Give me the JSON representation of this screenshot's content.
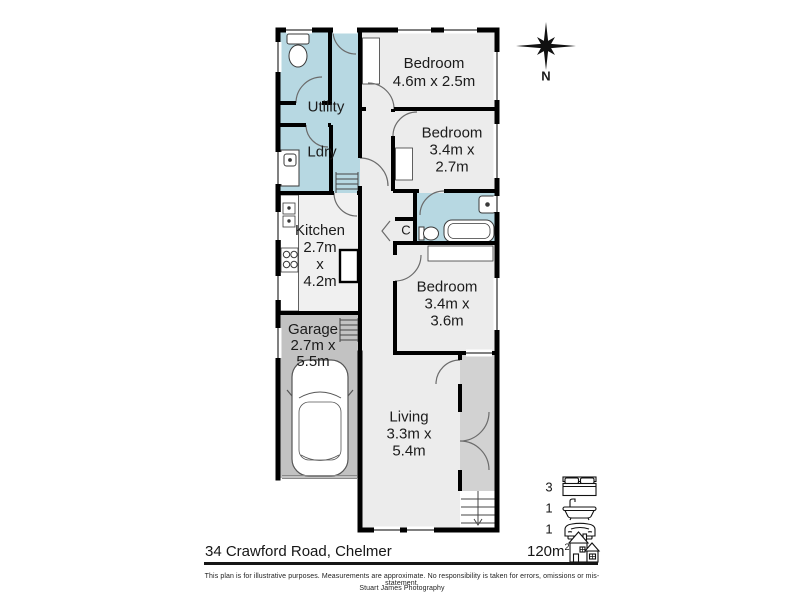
{
  "plan": {
    "compass_label": "N",
    "rooms": {
      "utility": {
        "label": "Utility"
      },
      "ldry": {
        "label": "Ldry"
      },
      "kitchen": {
        "lines": [
          "Kitchen",
          "2.7m",
          "x",
          "4.2m"
        ]
      },
      "garage": {
        "lines": [
          "Garage",
          "2.7m x",
          "5.5m"
        ]
      },
      "bedroom1": {
        "lines": [
          "Bedroom",
          "4.6m x 2.5m"
        ]
      },
      "bedroom2": {
        "lines": [
          "Bedroom",
          "3.4m x",
          "2.7m"
        ]
      },
      "bedroom3": {
        "lines": [
          "Bedroom",
          "3.4m x",
          "3.6m"
        ]
      },
      "living": {
        "lines": [
          "Living",
          "3.3m x",
          "5.4m"
        ]
      },
      "closet": {
        "label": "C"
      }
    },
    "colors": {
      "wet_area": "#b7d8e2",
      "floor": "#ececec",
      "garage": "#c2c2c2",
      "deck": "#d2d2d2",
      "wall": "#000000"
    }
  },
  "footer": {
    "address": "34 Crawford Road, Chelmer",
    "area_value": "120m",
    "area_sup": "2",
    "stats": {
      "beds": "3",
      "baths": "1",
      "cars": "1"
    },
    "disclaimer": "This plan is for illustrative purposes. Measurements are approximate. No responsibility is taken for errors, omissions or mis-statement.",
    "credit": "Stuart James Photography"
  }
}
